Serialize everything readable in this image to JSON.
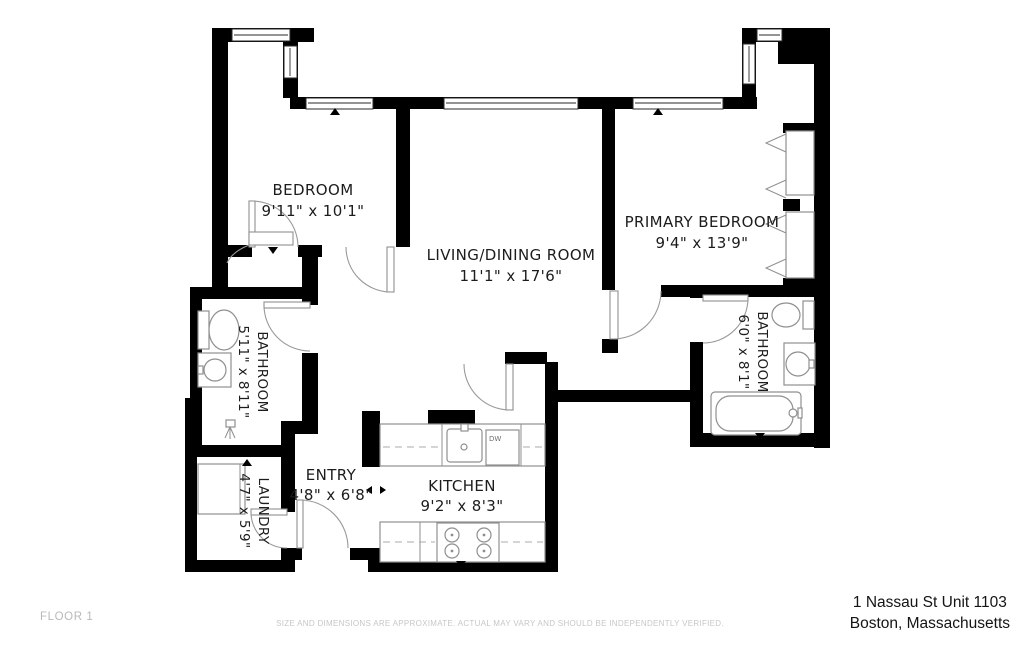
{
  "floorplan": {
    "rooms": [
      {
        "name": "BEDROOM",
        "dims": "9'11\" x 10'1\""
      },
      {
        "name": "LIVING/DINING ROOM",
        "dims": "11'1\" x 17'6\""
      },
      {
        "name": "PRIMARY BEDROOM",
        "dims": "9'4\" x 13'9\""
      },
      {
        "name": "BATHROOM",
        "dims": "5'11\" x 8'11\""
      },
      {
        "name": "BATHROOM",
        "dims": "6'0\" x 8'1\""
      },
      {
        "name": "ENTRY",
        "dims": "4'8\" x 6'8\""
      },
      {
        "name": "KITCHEN",
        "dims": "9'2\" x 8'3\""
      },
      {
        "name": "LAUNDRY",
        "dims": "4'7\" x 5'9\""
      }
    ],
    "labels": {
      "dishwasher": "DW"
    }
  },
  "footer": {
    "floor_label": "FLOOR 1",
    "disclaimer": "SIZE AND DIMENSIONS ARE APPROXIMATE. ACTUAL MAY VARY AND SHOULD BE INDEPENDENTLY VERIFIED.",
    "address_line1": "1 Nassau St Unit 1103",
    "address_line2": "Boston, Massachusetts"
  },
  "colors": {
    "wall": "#000000",
    "fixture_stroke": "#8f8f8f",
    "footer_gray": "#b9b9b9",
    "text": "#1c1c1c"
  }
}
